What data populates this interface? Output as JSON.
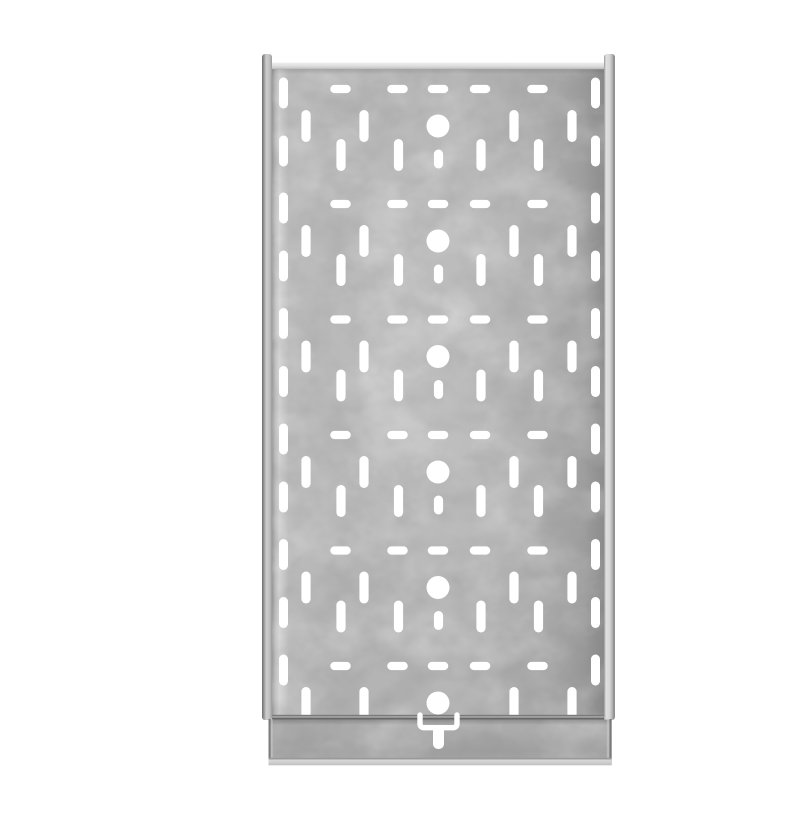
{
  "meta": {
    "description": "Top-down product photo of a galvanized steel perforated cable tray on a white background",
    "background": "#ffffff"
  },
  "palette": {
    "background": "#ffffff",
    "white_cutout": "#ffffff",
    "panel_base": "#b1b1b1",
    "panel_left_highlight": "#d3d3d3",
    "panel_right_shadow": "#8a8a8a",
    "top_fold_light": "#dedede",
    "rail_dark_edge": "#6e6e6e",
    "rail_body_light": "#cdcdcd",
    "right_rail_light": "#dcdcdc",
    "seam_dark": "#686868",
    "seam_upper": "#7a7a7a",
    "seam_gap": "#a9a9a9",
    "flange_top": "#afafaf",
    "flange_bottom": "#a0a0a0",
    "flange_edge_dark": "#747474",
    "edge_highlight": "#c9c9c9",
    "fold_line": "#9a9a9a",
    "lip_light": "#d4d4d4"
  },
  "geometry": {
    "canvas": {
      "w": 800,
      "h": 800
    },
    "parts": {
      "photo_background": {
        "x": 0,
        "y": 0,
        "w": 800,
        "h": 800,
        "fill": "background"
      },
      "bottom_flange": {
        "x": 228.5,
        "y": 702.5,
        "w": 343,
        "h": 40.5
      },
      "left_side_rail": {
        "x": 222,
        "y": 38,
        "w": 10,
        "h": 666,
        "rx": 3
      },
      "right_side_rail": {
        "x": 564,
        "y": 38,
        "w": 11,
        "h": 666,
        "rx": 3
      },
      "tray_panel": {
        "x": 232,
        "y": 48,
        "w": 332,
        "h": 652
      },
      "panel_center_sheen": {
        "x": 232,
        "y": 48,
        "w": 332,
        "h": 652
      },
      "panel_texture_light": {
        "x": 222,
        "y": 46,
        "w": 353,
        "h": 703,
        "opacity": 0.5
      },
      "panel_texture_dark": {
        "x": 222,
        "y": 46,
        "w": 353,
        "h": 703,
        "opacity": 0.38
      },
      "top_fold_edge": {
        "x": 232,
        "y": 46.5,
        "w": 332,
        "h": 6.8
      },
      "panel_top_shadow": {
        "x": 232,
        "y": 53.3,
        "w": 332,
        "h": 5,
        "opacity": 0.5
      },
      "seam_line_upper": {
        "x": 232,
        "y": 698.8,
        "w": 332,
        "h": 1.6,
        "fill": "seam_upper"
      },
      "seam_line_gap": {
        "x": 232,
        "y": 700.4,
        "w": 332,
        "h": 1.2,
        "fill": "seam_gap"
      },
      "seam_line_lower": {
        "x": 232,
        "y": 701.6,
        "w": 332,
        "h": 1.9,
        "fill": "seam_dark"
      },
      "flange_top_shadow": {
        "x": 228.5,
        "y": 703.5,
        "w": 343,
        "h": 5.5,
        "opacity": 0.9
      },
      "flange_left_edge_line": {
        "x": 228.5,
        "y": 703,
        "w": 2.2,
        "h": 45.5,
        "fill": "flange_edge_dark",
        "opacity": 0.85
      },
      "flange_left_edge_highlight": {
        "x": 230.7,
        "y": 703,
        "w": 2.0,
        "h": 39,
        "fill": "edge_highlight",
        "opacity": 0.6
      },
      "flange_right_edge_line": {
        "x": 569.4,
        "y": 703,
        "w": 2.3,
        "h": 46,
        "fill": "flange_edge_dark",
        "opacity": 0.9
      },
      "flange_right_edge_highlight": {
        "x": 566.8,
        "y": 703,
        "w": 2.6,
        "h": 39,
        "fill": "edge_highlight",
        "opacity": 0.6
      },
      "flange_fold_line": {
        "x": 228.5,
        "y": 741.8,
        "w": 343,
        "h": 1.7,
        "fill": "fold_line"
      },
      "bottom_lip": {
        "x": 228.5,
        "y": 743.5,
        "w": 343,
        "h": 5.8
      },
      "clip_panel_rect": {
        "x": 232,
        "y": 48,
        "w": 332,
        "h": 652
      },
      "clip_tray_rect_a": {
        "x": 232,
        "y": 48,
        "w": 332,
        "h": 652
      },
      "clip_tray_rect_b": {
        "x": 228.5,
        "y": 702.5,
        "w": 343,
        "h": 41
      }
    },
    "pattern": {
      "row_anchors_y": [
        73,
        188,
        303.5,
        419,
        534.5,
        650
      ],
      "dash_row": {
        "centers_x": [
          300.5,
          357.5,
          398,
          440,
          497.5
        ],
        "w": 20.5,
        "h": 8.2,
        "offset_y": 0
      },
      "long_slot_row": {
        "centers_x": [
          266,
          324,
          474,
          532
        ],
        "w": 9.2,
        "h": 32,
        "offset_y": 37
      },
      "center_circle": {
        "cx": 398,
        "r": 11.5,
        "offset_y": 37
      },
      "medium_slot_row": {
        "centers_x": [
          301,
          358.5,
          441,
          498.5
        ],
        "w": 9.2,
        "h": 32,
        "offset_y": 66,
        "omit_last_row": true
      },
      "center_short_slot": {
        "cx": 398.5,
        "w": 9.2,
        "h": 19,
        "offset_y": 70,
        "omit_last_row": true
      },
      "edge_slot_columns": {
        "centers_x": [
          243.5,
          555.5
        ],
        "w": 9,
        "h": 31,
        "offsets_y": [
          4,
          62
        ],
        "omit_last_second": true
      }
    },
    "handle": {
      "arm_left_cx": 380,
      "arm_right_cx": 417,
      "arm_top_y": 699,
      "bar_cy": 711.7,
      "corner_r": 4.2,
      "stroke_w": 5.4,
      "stem": {
        "cx": 398.5,
        "w": 11,
        "top_y": 710,
        "bottom_y": 733,
        "r": 5
      }
    }
  }
}
